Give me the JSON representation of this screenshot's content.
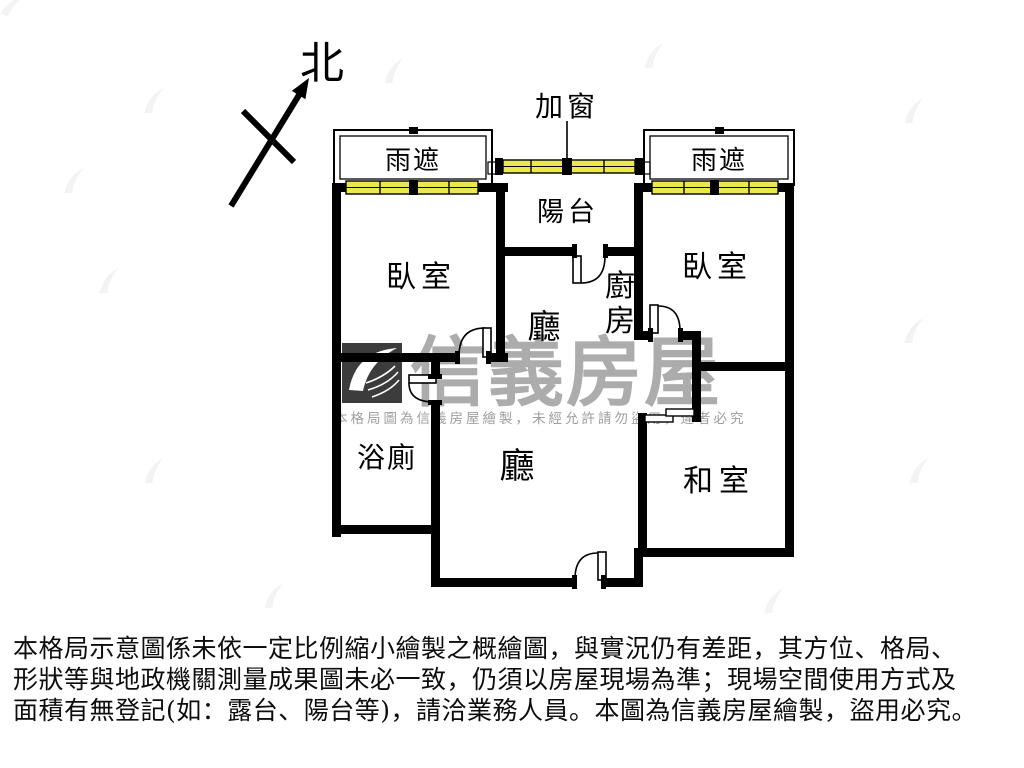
{
  "plan": {
    "north_label": "北",
    "added_window_label": "加窗",
    "rain_shelter_left": "雨遮",
    "rain_shelter_right": "雨遮",
    "balcony": "陽台",
    "bedroom_left": "臥室",
    "bedroom_right": "臥室",
    "hall_upper": "廳",
    "hall_main": "廳",
    "kitchen_char1": "廚",
    "kitchen_char2": "房",
    "bathroom": "浴廁",
    "tatami": "和室"
  },
  "watermark": {
    "brand": "信義房屋",
    "notice": "本格局圖為信義房屋繪製，未經允許請勿盜用，違者必究"
  },
  "disclaimer": {
    "line1": "本格局示意圖係未依一定比例縮小繪製之概繪圖，與實況仍有差距，其方位、格局、",
    "line2": "形狀等與地政機關測量成果圖未必一致，仍須以房屋現場為準；現場空間使用方式及",
    "line3": "面積有無登記(如：露台、陽台等)，請洽業務人員。本圖為信義房屋繪製，盜用必究。"
  },
  "colors": {
    "wall": "#000000",
    "window_fill": "#ebe84d",
    "watermark_gray": "#acacac",
    "logo_bg": "#3c3c3c"
  }
}
